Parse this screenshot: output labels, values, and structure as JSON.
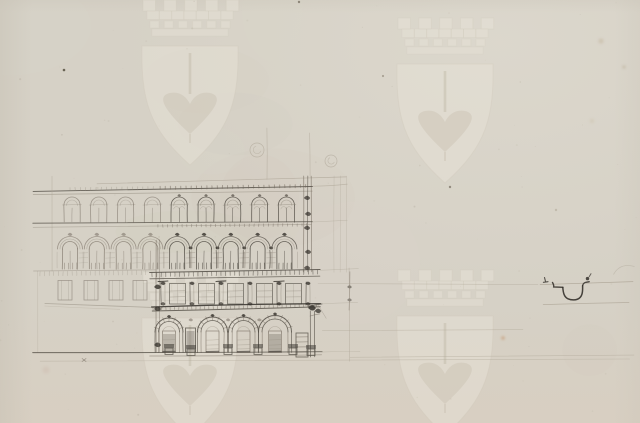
{
  "document": {
    "kind": "scanned archival sheet",
    "content": "pencil facade elevation study of a palazzo with arcaded ground floor; small eaves-gutter profile detail at right; no text on sheet",
    "text_content": ""
  },
  "canvas": {
    "width": 640,
    "height": 423
  },
  "palette": {
    "paper": "#d6d1c6",
    "paper_warm": "#d9cdbe",
    "paper_shade": "#c6c0b3",
    "paper_light": "#e0dcd1",
    "watermark_fill": "#e7e2d7",
    "watermark_line": "#c9c2b2",
    "watermark_dark": "#c2bba9",
    "ink_dark": "#35312b",
    "ink": "#524d45",
    "ink_mid": "#6e6459",
    "ink_light": "#8f887b",
    "ink_faint": "#aba394"
  },
  "watermark": {
    "motif": "two-tier mural crown above pointed shield bearing halberd",
    "instances": [
      {
        "cx": 190,
        "shield_top": 46
      },
      {
        "cx": 445,
        "shield_top": 64
      },
      {
        "cx": 190,
        "shield_top": 318
      },
      {
        "cx": 445,
        "shield_top": 316
      }
    ]
  },
  "facade": {
    "cornice_left": 33,
    "left_edge": 52,
    "split": 157,
    "right_main": 312,
    "right_ext": 347,
    "roof": {
      "slope_line": [
        97,
        183.5,
        346,
        176.5
      ],
      "main": [
        33,
        191,
        312,
        186.2
      ],
      "ext": [
        312,
        186.2,
        347,
        184.6
      ],
      "sub": [
        33,
        194.5,
        312,
        190.6
      ],
      "dentils": [
        70,
        310,
        187.6,
        5.2
      ]
    },
    "floor3": {
      "start": 64,
      "pitch": 26.8,
      "count": 9,
      "w": 16,
      "spring": 205,
      "sill": 222
    },
    "string": {
      "a": [
        33,
        223.5,
        312,
        221.4
      ],
      "b": [
        33,
        227,
        312,
        224.8
      ],
      "ext": [
        312,
        221.4,
        347,
        220.2
      ]
    },
    "floor2": {
      "start": 61,
      "pitch": 26.8,
      "count": 9,
      "w": 18,
      "band_spring": 249,
      "spring": 249,
      "sill": 269,
      "baluster_top": 263
    },
    "balcony": {
      "light": [
        33,
        271.5,
        155,
        270.2
      ],
      "a": [
        150,
        272.6,
        320,
        269.6
      ],
      "b": [
        150,
        278.6,
        320,
        275.8
      ],
      "ext": [
        320,
        269.8,
        358,
        268.8
      ]
    },
    "mezz_left": {
      "xs": [
        58,
        84,
        109,
        133
      ],
      "w": 14,
      "top": 280.5,
      "h": 19.5,
      "sill": [
        45,
        303,
        162,
        307.5
      ],
      "sill2": [
        45,
        306,
        120,
        309
      ]
    },
    "mezz_right": {
      "pilasters": [
        163,
        192,
        221,
        250,
        279,
        308
      ],
      "caps": [
        163,
        221,
        279
      ],
      "top": 282,
      "bottom": 305
    },
    "heavy_cornice": {
      "a": [
        152,
        306.6,
        320,
        303.2
      ],
      "b": [
        152,
        310.6,
        320,
        307.2
      ],
      "ext": [
        320,
        303.6,
        358,
        302.4
      ]
    },
    "arcade": {
      "arches": [
        {
          "c": 169,
          "r": 14
        },
        {
          "c": 212.5,
          "r": 15
        },
        {
          "c": 243.5,
          "r": 15
        },
        {
          "c": 275,
          "r": 16.5
        }
      ],
      "spring": 332,
      "narrow_door": [
        185.5,
        328,
        10,
        24
      ],
      "lattice_bay": [
        296,
        333,
        12,
        24
      ],
      "corner_x": [
        310.5,
        314.5
      ],
      "console": [
        308,
        305,
        322,
        316
      ]
    },
    "base": {
      "main": [
        33,
        353,
        322,
        351.6
      ],
      "sub": [
        150,
        356.4,
        322,
        355
      ],
      "ext": [
        322,
        352,
        360,
        351.6
      ]
    }
  },
  "detail_sketch": {
    "label": "eaves-gutter profile detail",
    "guide_top": [
      540,
      284.8,
      633,
      281.8
    ],
    "guide_bottom": [
      543,
      304.8,
      629,
      302.6
    ],
    "profile_center": [
      573,
      293
    ]
  },
  "construction": {
    "verticals": [
      [
        267,
        128,
        267,
        179
      ],
      [
        310,
        133,
        310,
        176
      ],
      [
        349.5,
        268,
        349.5,
        361
      ]
    ],
    "guides": [
      [
        318,
        283.8,
        538,
        284.4
      ],
      [
        322,
        330.8,
        523,
        329.7
      ],
      [
        350,
        357,
        634,
        355.2
      ],
      [
        40,
        361.5,
        630,
        359.4
      ]
    ],
    "circles": [
      {
        "cx": 257,
        "cy": 150,
        "r": 7
      },
      {
        "cx": 331,
        "cy": 161,
        "r": 6
      }
    ],
    "cross_tick": [
      84,
      360
    ],
    "curl": [
      613.5,
      274.5,
      620,
      262.5,
      634.5,
      266.5
    ]
  },
  "blemishes": [
    {
      "x": 64,
      "y": 70,
      "r": 1.3,
      "c": "#56503f",
      "o": 0.85
    },
    {
      "x": 299,
      "y": 2,
      "r": 1.2,
      "c": "#6e6759",
      "o": 0.7
    },
    {
      "x": 383,
      "y": 76,
      "r": 1.1,
      "c": "#8a8172",
      "o": 0.6
    },
    {
      "x": 450,
      "y": 187,
      "r": 1.2,
      "c": "#6e6557",
      "o": 0.65
    },
    {
      "x": 503,
      "y": 338,
      "r": 1.8,
      "c": "#c08a5e",
      "o": 0.55
    },
    {
      "x": 601,
      "y": 41,
      "r": 2.6,
      "c": "#c3b59c",
      "o": 0.5
    },
    {
      "x": 624,
      "y": 67,
      "r": 1.6,
      "c": "#b5a88e",
      "o": 0.5
    },
    {
      "x": 592,
      "y": 121,
      "r": 2.0,
      "c": "#c9bca4",
      "o": 0.4
    },
    {
      "x": 46,
      "y": 370,
      "r": 3.5,
      "c": "#c9b3a6",
      "o": 0.3
    },
    {
      "x": 556,
      "y": 210,
      "r": 1.2,
      "c": "#a99e8c",
      "o": 0.45
    }
  ]
}
